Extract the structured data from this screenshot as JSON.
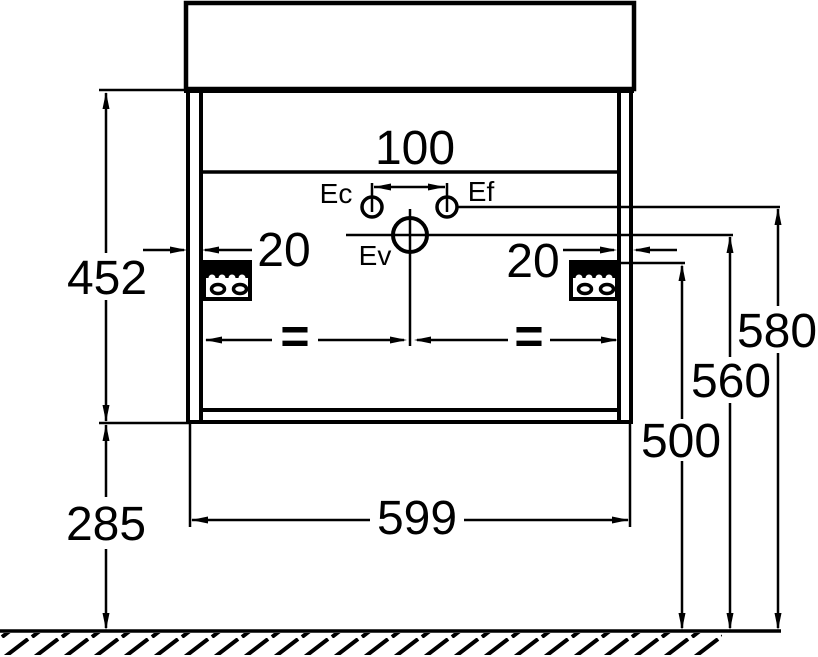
{
  "labels": {
    "dim_100": "100",
    "dim_452": "452",
    "dim_285": "285",
    "dim_599": "599",
    "dim_500": "500",
    "dim_560": "560",
    "dim_580": "580",
    "dim_20_left": "20",
    "dim_20_right": "20",
    "eq_left": "=",
    "eq_right": "=",
    "ec": "Ec",
    "ef": "Ef",
    "ev": "Ev"
  },
  "colors": {
    "line": "#000000",
    "background": "#ffffff"
  }
}
